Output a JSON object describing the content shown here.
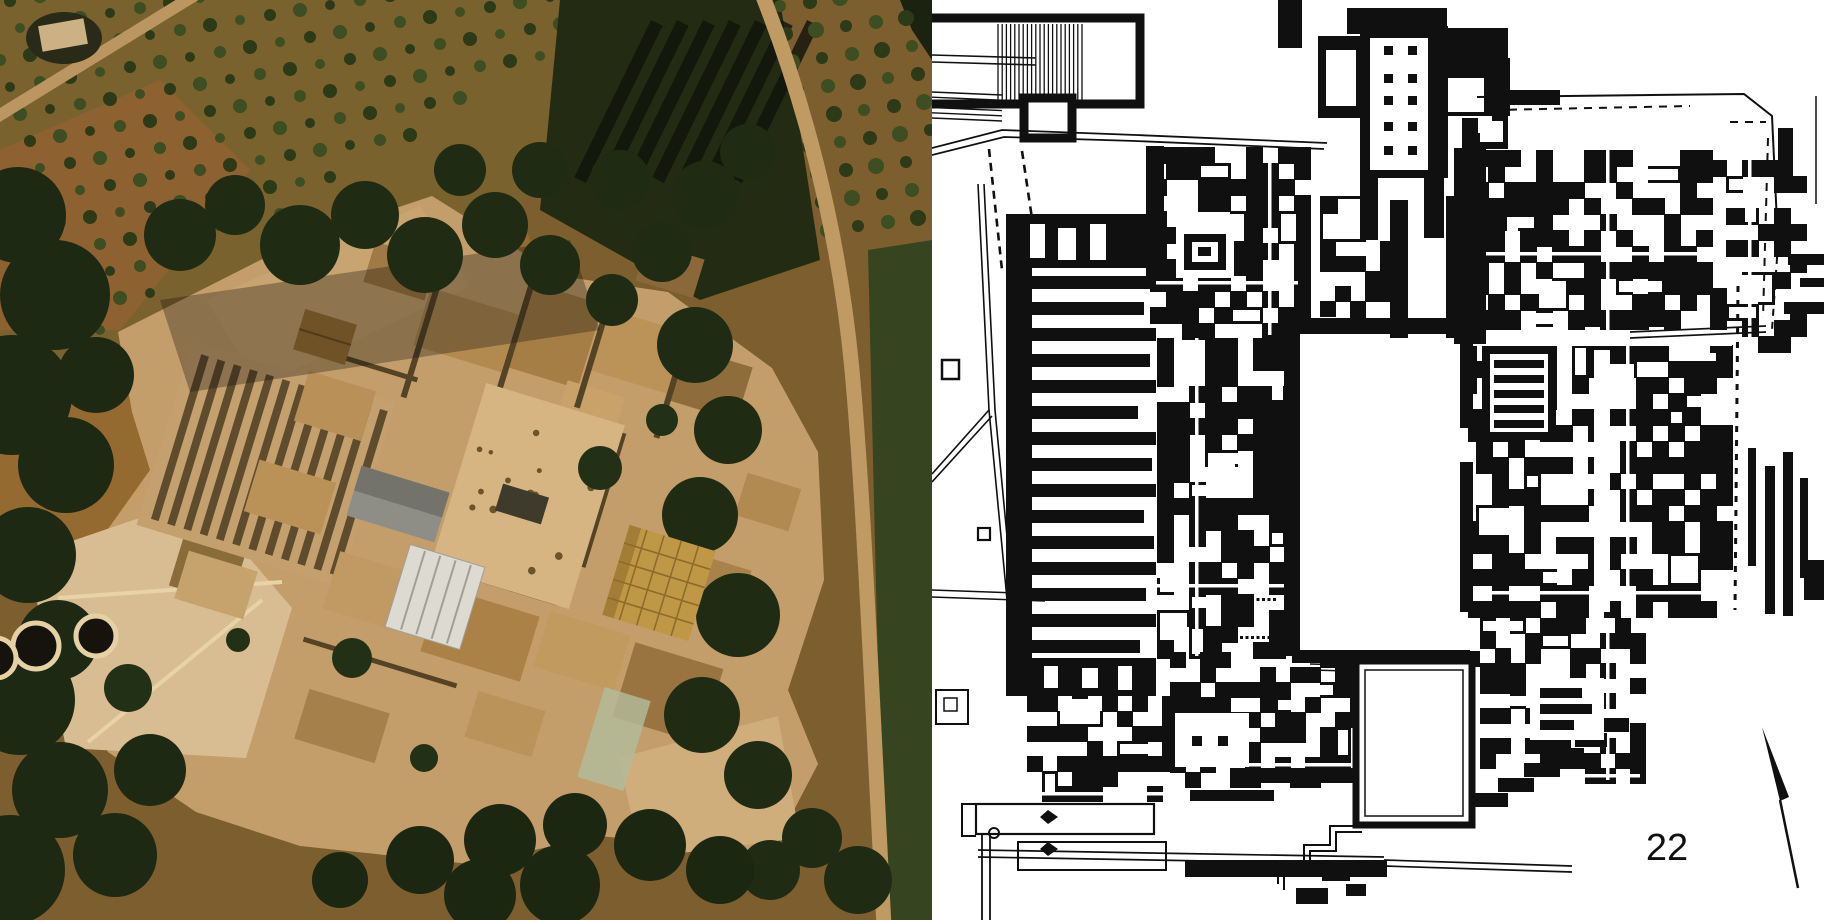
{
  "page_number": "22",
  "photo": {
    "palette": {
      "soil": "#7c5e2f",
      "grove_soil": "#7a622e",
      "scrub": "#8e6230",
      "field": "#956a31",
      "tree_dark": "#1e2913",
      "tree_band": "#202b13",
      "tree_right": "#202b13",
      "tree_bottom": "#1c2712",
      "ruins": "#c39e6a",
      "ruins_light": "#d9bd92",
      "court": "#d6b583",
      "stripe_dark": "#5f4c2c",
      "stripe_base": "#c4a06e",
      "road": "#bf9a62",
      "pit": "#16130c",
      "pit_rim": "#e6d1a4",
      "roof_grey": "#8f8e86",
      "roof_grey_dark": "#74736b",
      "roof_light": "#dcdad1",
      "roof_light_line": "#a09e96",
      "roof_gold": "#c09745",
      "roof_gold_line": "#8c6c2c",
      "roof_brown": "#6f5226",
      "glass": "#b2bb9b",
      "path_light": "#e7d3a6",
      "speckle": "#6b5429",
      "shadow": "#17130b",
      "olive_a": "#2c3a18",
      "olive_b": "#3c4e22",
      "shadow_stripe": "#10130a"
    },
    "angle": 17,
    "olive_grove": {
      "cols": 24,
      "rows": 14,
      "r": 6
    },
    "olive_grove_right": {
      "cols": 5,
      "rows": 9,
      "r": 7
    },
    "shadow_stripes": {
      "count": 7,
      "x0": 612,
      "y0": 14,
      "pitch": 26,
      "w": 13,
      "h": 175,
      "rot": 26
    },
    "magazine_stripes": {
      "count": 12,
      "x0": 172,
      "y0": 378,
      "pitch": 17,
      "w": 8,
      "h": 172
    },
    "tree_masses": [
      {
        "color": "#1e2913",
        "blobs": [
          [
            18,
            215,
            48
          ],
          [
            55,
            295,
            55
          ],
          [
            12,
            395,
            60
          ],
          [
            66,
            465,
            48
          ],
          [
            28,
            555,
            48
          ],
          [
            96,
            375,
            38
          ],
          [
            58,
            640,
            40
          ],
          [
            20,
            700,
            55
          ],
          [
            60,
            790,
            48
          ],
          [
            10,
            870,
            55
          ],
          [
            115,
            855,
            42
          ],
          [
            150,
            770,
            36
          ]
        ]
      },
      {
        "color": "#202b13",
        "blobs": [
          [
            180,
            235,
            36
          ],
          [
            235,
            205,
            30
          ],
          [
            300,
            245,
            40
          ],
          [
            365,
            215,
            34
          ],
          [
            425,
            255,
            38
          ],
          [
            495,
            225,
            33
          ],
          [
            550,
            265,
            30
          ],
          [
            612,
            300,
            26
          ],
          [
            662,
            252,
            30
          ],
          [
            705,
            195,
            34
          ],
          [
            748,
            152,
            28
          ],
          [
            620,
            180,
            30
          ],
          [
            540,
            170,
            28
          ],
          [
            460,
            170,
            26
          ]
        ]
      },
      {
        "color": "#202b13",
        "blobs": [
          [
            695,
            345,
            38
          ],
          [
            728,
            430,
            34
          ],
          [
            700,
            515,
            38
          ],
          [
            738,
            615,
            42
          ],
          [
            702,
            715,
            38
          ],
          [
            758,
            775,
            34
          ],
          [
            812,
            838,
            30
          ],
          [
            858,
            880,
            34
          ],
          [
            770,
            870,
            30
          ]
        ]
      },
      {
        "color": "#1c2712",
        "blobs": [
          [
            420,
            860,
            34
          ],
          [
            500,
            840,
            36
          ],
          [
            575,
            825,
            32
          ],
          [
            650,
            845,
            36
          ],
          [
            720,
            870,
            34
          ],
          [
            560,
            885,
            40
          ],
          [
            480,
            895,
            36
          ],
          [
            340,
            880,
            28
          ]
        ]
      }
    ],
    "lone_trees": [
      [
        352,
        658,
        20
      ],
      [
        600,
        468,
        22
      ],
      [
        128,
        688,
        24
      ],
      [
        424,
        758,
        14
      ],
      [
        662,
        420,
        16
      ],
      [
        238,
        640,
        12
      ]
    ],
    "kouloures": [
      [
        36,
        646,
        23
      ],
      [
        96,
        636,
        20
      ],
      [
        -4,
        658,
        20
      ]
    ],
    "court_rect": [
      455,
      400,
      145,
      192
    ],
    "court_speckles": 16,
    "rooms": [
      [
        420,
        300,
        92,
        60,
        "#b28a50"
      ],
      [
        520,
        292,
        72,
        88,
        "#a57e46"
      ],
      [
        598,
        320,
        84,
        64,
        "#bb9258"
      ],
      [
        676,
        356,
        70,
        56,
        "#8f6c3c"
      ],
      [
        560,
        388,
        60,
        44,
        "#c8a268"
      ],
      [
        300,
        380,
        70,
        52,
        "#b89058"
      ],
      [
        428,
        600,
        104,
        68,
        "#ab8148"
      ],
      [
        540,
        622,
        84,
        58,
        "#c19a60"
      ],
      [
        622,
        654,
        92,
        78,
        "#9a7440"
      ],
      [
        330,
        560,
        70,
        60,
        "#c09a62"
      ],
      [
        250,
        470,
        80,
        54,
        "#ba9258"
      ],
      [
        180,
        560,
        72,
        50,
        "#c6a26c"
      ],
      [
        680,
        560,
        66,
        48,
        "#a8824a"
      ],
      [
        740,
        480,
        56,
        44,
        "#b08a50"
      ],
      [
        640,
        250,
        60,
        40,
        "#8a683a"
      ],
      [
        368,
        250,
        64,
        42,
        "#a07a44"
      ],
      [
        470,
        700,
        70,
        48,
        "#b9935a"
      ],
      [
        300,
        700,
        84,
        52,
        "#a5804a"
      ]
    ],
    "walls": [
      [
        418,
        280,
        6,
        120
      ],
      [
        510,
        280,
        6,
        130
      ],
      [
        590,
        300,
        6,
        110
      ],
      [
        668,
        340,
        6,
        100
      ],
      [
        300,
        360,
        120,
        5
      ],
      [
        420,
        580,
        140,
        5
      ],
      [
        300,
        660,
        160,
        5
      ],
      [
        600,
        430,
        6,
        140
      ]
    ]
  },
  "plan": {
    "ink": "#101010",
    "paper": "#ffffff",
    "magazines": {
      "x": 96,
      "y0": 276,
      "pitch": 26,
      "thickness": 13,
      "lengths": [
        128,
        116,
        128,
        122,
        128,
        110,
        128,
        124,
        128,
        116,
        126,
        128,
        118,
        128,
        112,
        124
      ]
    },
    "pillar_hall": {
      "cols": [
        452,
        476
      ],
      "rows": [
        46,
        74,
        96,
        122,
        146
      ],
      "size": 9
    },
    "theatral_hatch": {
      "x0": 66,
      "x1": 152,
      "step": 4.2,
      "y0": 24,
      "y1": 100
    },
    "colonnades": [
      {
        "x0": 308,
        "y": 598,
        "n": 7,
        "pitch": 5.5,
        "s": 3
      },
      {
        "x0": 308,
        "y": 636,
        "n": 7,
        "pitch": 5.5,
        "s": 3
      }
    ],
    "right_edge_bars": [
      [
        816,
        448,
        8,
        118
      ],
      [
        833,
        466,
        10,
        148
      ],
      [
        851,
        452,
        10,
        164
      ],
      [
        868,
        478,
        8,
        100
      ]
    ],
    "se_steps": [
      [
        540,
        793,
        36,
        14
      ],
      [
        566,
        778,
        36,
        14
      ],
      [
        592,
        763,
        36,
        14
      ],
      [
        618,
        748,
        34,
        14
      ],
      [
        643,
        733,
        32,
        14
      ],
      [
        667,
        718,
        30,
        14
      ]
    ],
    "zones": [
      {
        "x": 218,
        "y": 147,
        "w": 148,
        "h": 188,
        "cell": 16,
        "density": 0.62,
        "rooms": 7,
        "seed": 11
      },
      {
        "x": 388,
        "y": 196,
        "w": 70,
        "h": 138,
        "cell": 15,
        "density": 0.5,
        "rooms": 4,
        "seed": 21
      },
      {
        "x": 515,
        "y": 28,
        "w": 58,
        "h": 116,
        "cell": 15,
        "density": 0.5,
        "rooms": 3,
        "seed": 41
      },
      {
        "x": 540,
        "y": 150,
        "w": 236,
        "h": 192,
        "cell": 16,
        "density": 0.6,
        "rooms": 9,
        "seed": 31
      },
      {
        "x": 778,
        "y": 160,
        "w": 92,
        "h": 178,
        "cell": 16,
        "density": 0.42,
        "rooms": 4,
        "seed": 91
      },
      {
        "x": 225,
        "y": 338,
        "w": 130,
        "h": 318,
        "cell": 16,
        "density": 0.62,
        "rooms": 10,
        "seed": 51
      },
      {
        "x": 528,
        "y": 345,
        "w": 268,
        "h": 268,
        "cell": 16,
        "density": 0.6,
        "rooms": 11,
        "seed": 61
      },
      {
        "x": 238,
        "y": 652,
        "w": 218,
        "h": 128,
        "cell": 15,
        "density": 0.58,
        "rooms": 7,
        "seed": 71
      },
      {
        "x": 95,
        "y": 696,
        "w": 140,
        "h": 100,
        "cell": 15,
        "density": 0.5,
        "rooms": 4,
        "seed": 101
      },
      {
        "x": 548,
        "y": 618,
        "w": 160,
        "h": 162,
        "cell": 15,
        "density": 0.52,
        "rooms": 6,
        "seed": 81
      }
    ]
  }
}
